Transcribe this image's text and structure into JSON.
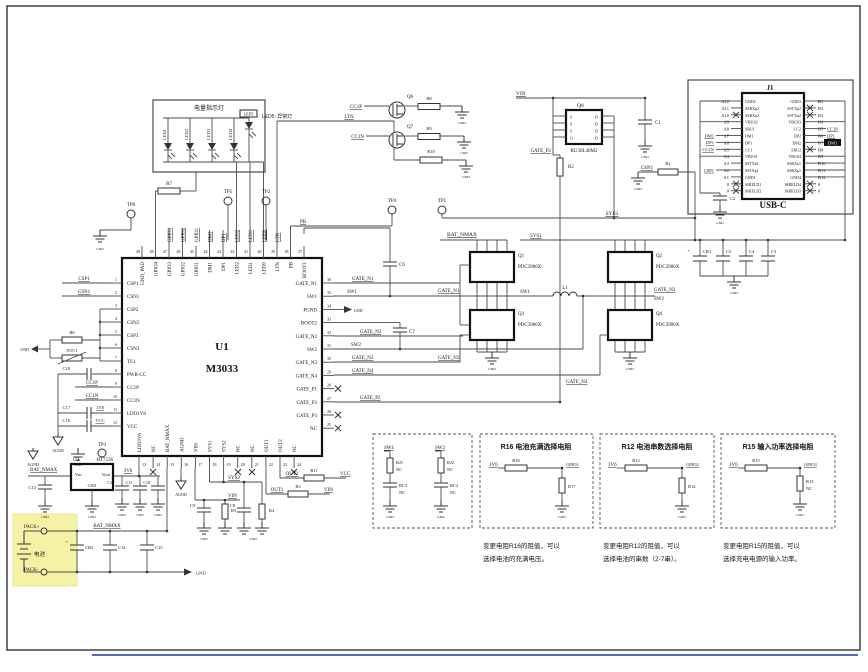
{
  "led_box": {
    "title": "电量指示灯",
    "leds": [
      "LED1",
      "LED2",
      "LED3",
      "LED4"
    ],
    "led5": "LED5",
    "note": "LED5: 异常灯"
  },
  "nets": {
    "gnd": "GND",
    "agnd": "AGND",
    "vin": "VIN",
    "vcc": "VCC",
    "v3v6": "3V6",
    "v1v8": "1V8",
    "ltn": "LTN",
    "pb": "PB",
    "sw1": "SW1",
    "sw2": "SW2",
    "sys1": "SYS1",
    "sys3": "SYS3",
    "bat_nmax": "BAT_NMAX",
    "cc1p": "CC1P",
    "cc1n": "CC1N",
    "csn1": "CSN1",
    "csp1": "CSP1",
    "out1": "OUT1",
    "out2": "OUT2",
    "gate_n1": "GATE_N1",
    "gate_n2": "GATE_N2",
    "gate_n3": "GATE_N3",
    "gate_n4": "GATE_N4",
    "gate_p2": "GATE_P2",
    "pack_pos": "PACK+",
    "pack_neg": "PACK-",
    "battery": "电池"
  },
  "marks": {
    "plus": "+"
  },
  "testpoints": {
    "tp1": "TP1",
    "tp2": "TP2",
    "tp3": "TP3",
    "tp4": "TP4",
    "tp5": "TP5",
    "tp6": "TP6"
  },
  "u1": {
    "ref": "U1",
    "part": "M3033",
    "left_pins": [
      "CSP1",
      "CSN1",
      "CSP2",
      "CSN2",
      "CSP3",
      "CSN3",
      "TS1",
      "PWR-CC",
      "CC1P",
      "CC1N",
      "LDO1V8",
      "VCC"
    ],
    "left_nums": [
      "1",
      "2",
      "3",
      "4",
      "5",
      "6",
      "7",
      "8",
      "9",
      "10",
      "11",
      "12"
    ],
    "right_pins": [
      "GATE_N1",
      "SW1",
      "PGND",
      "BOOT2",
      "GATE_N2",
      "SW2",
      "GATE_N3",
      "GATE_N4",
      "GATE_P1",
      "GATE_P2",
      "GATE_P3",
      "NC"
    ],
    "right_nums": [
      "36",
      "35",
      "34",
      "33",
      "32",
      "31",
      "30",
      "29",
      "28",
      "27",
      "26",
      "25"
    ],
    "top_pins": [
      "GND_PAD",
      "GPIO4",
      "GPIO3",
      "GPIO2",
      "GPIO1",
      "DM1",
      "DP1",
      "LED2",
      "LED1",
      "LED0",
      "LTN",
      "PB",
      "BOOT1"
    ],
    "top_nums": [
      "49",
      "48",
      "47",
      "46",
      "45",
      "44",
      "43",
      "42",
      "41",
      "40",
      "39",
      "38",
      "37"
    ],
    "top_nets": [
      "GPIO3",
      "GPIO2",
      "GPIO1",
      "DM1",
      "DP1",
      "LED2",
      "LED1",
      "LED0",
      "LTN"
    ],
    "bottom_pins": [
      "LDO3V6",
      "NC",
      "BAT_NMAX",
      "AGND",
      "VIN",
      "SYS1",
      "SYS2",
      "NC",
      "NC",
      "OUT1",
      "OUT2",
      "NC"
    ],
    "bottom_nums": [
      "13",
      "14",
      "15",
      "16",
      "17",
      "18",
      "19",
      "20",
      "21",
      "22",
      "23",
      "24"
    ]
  },
  "u2": {
    "ref": "U2",
    "part": "HT7536",
    "pin_vin": "Vin",
    "pin_vout": "Vout",
    "pin_gnd": "GND"
  },
  "q8": {
    "ref": "Q8",
    "part": "RU30L40M2",
    "left_letters": [
      "S",
      "S",
      "S",
      "G"
    ],
    "right_letters": [
      "D",
      "D",
      "D",
      "D"
    ]
  },
  "fets": {
    "q1": "Q1",
    "q2": "Q2",
    "q3": "Q3",
    "q4": "Q4",
    "q6": "Q6",
    "q7": "Q7",
    "part": "PDC3906X"
  },
  "inductor": {
    "l1": "L1"
  },
  "resistors": {
    "r1": "R1",
    "r2": "R2",
    "r3": "R3",
    "r4": "R4",
    "r5": "R5",
    "r6": "R6",
    "r7": "R7",
    "r8": "R8",
    "r9": "R9",
    "r10": "R10",
    "r11": "R11",
    "ntc1": "NTC1"
  },
  "caps": {
    "c1": "C1",
    "c2": "C2",
    "c3": "C3",
    "c4": "C4",
    "c5": "C5",
    "c6": "C6",
    "c7": "C7",
    "c8": "C8",
    "c9": "C9",
    "c10": "C10",
    "c11": "C11",
    "c12": "C12",
    "c13": "C13",
    "c14": "C14",
    "c15": "C15",
    "c16": "C16",
    "c17": "C17",
    "c18": "C18",
    "cb1": "CB1",
    "cb2": "CB2"
  },
  "usb": {
    "ref": "J1",
    "name": "USB-C",
    "c2": "C2",
    "left_ids": [
      "A12",
      "A11",
      "A10",
      "A9",
      "A8",
      "A7",
      "A6",
      "A5",
      "A4",
      "A3",
      "A2",
      "A1",
      "0",
      "0"
    ],
    "left_inner": [
      "GND2",
      "SSRXp2",
      "SSRXn2",
      "VBUS2",
      "SBU1",
      "DM1",
      "DP1",
      "CC1",
      "VBUS1",
      "SSTXn1",
      "SSTXp1",
      "GND1",
      "SHIELD1",
      "SHIELD2"
    ],
    "right_inner": [
      "GND3",
      "SSTXp2",
      "SSTXn2",
      "VBUS3",
      "CC2",
      "DP2",
      "DM2",
      "SBU2",
      "VBUS4",
      "SSRXn1",
      "SSRXp1",
      "GND4",
      "SHIELD4",
      "SHIELD3"
    ],
    "right_ids": [
      "B1",
      "B2",
      "B3",
      "B4",
      "B5",
      "B6",
      "B7",
      "B8",
      "B9",
      "B10",
      "B11",
      "B12",
      "0",
      "0"
    ],
    "ext": {
      "dm1": "DM1",
      "dp1": "DP1",
      "cc1n": "CC1N",
      "csp1": "CSP1",
      "cc1p": "CC1P"
    }
  },
  "sel_boxes": {
    "a": {
      "sw1": "SW1",
      "sw2": "SW2",
      "rj1": "RJ1",
      "rj2": "RJ2",
      "rc3": "RC3",
      "rc2": "RC2",
      "nc": "NC"
    },
    "b": {
      "title": "R16 电池充满选择电阻",
      "rail": "3V6",
      "r_series": "R16",
      "gpio": "GPIO1",
      "r_shunt": "R17",
      "cap1": "变更电阻R16的阻值，可以",
      "cap2": "选择电池的充满电压。"
    },
    "c": {
      "title": "R12 电池串数选择电阻",
      "rail": "3V6",
      "r_series": "R12",
      "gpio": "GPIO2",
      "r_shunt": "R14",
      "cap1": "变更电阻R12的阻值，可以",
      "cap2": "选择电池的串数（2-7串）。"
    },
    "d": {
      "title": "R15 输入功率选择电阻",
      "rail": "3V6",
      "r_series": "R15",
      "gpio": "GPIO3",
      "r_shunt": "R13",
      "nc": "NC",
      "cap1": "变更电阻R15的阻值，可以",
      "cap2": "选择充电电源的输入功率。"
    }
  }
}
